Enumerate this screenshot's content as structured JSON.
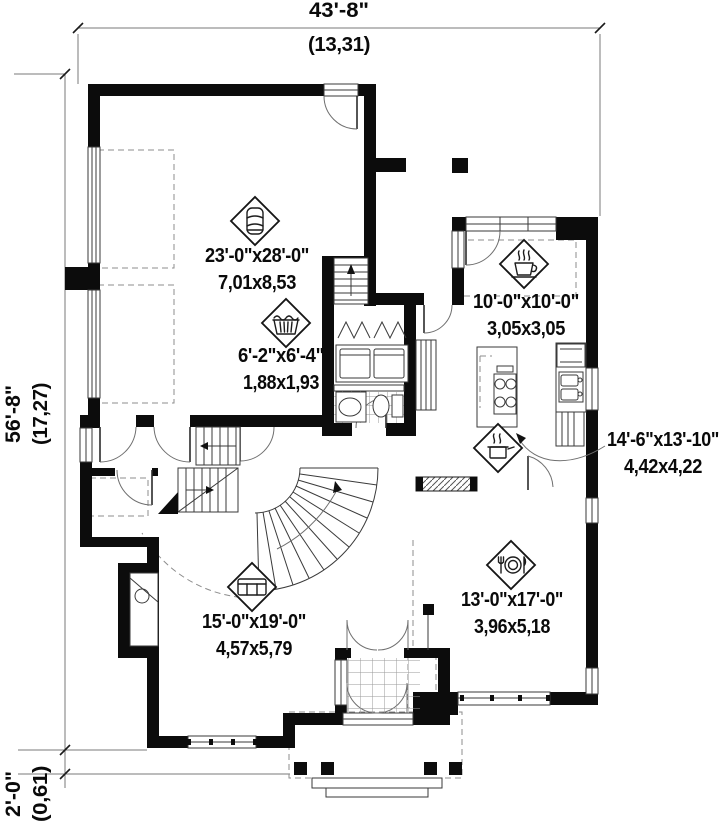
{
  "plan": {
    "title": "first-floor-plan",
    "dimensions": {
      "width": {
        "imperial": "43'-8\"",
        "metric": "(13,31)"
      },
      "height": {
        "imperial": "56'-8\"",
        "metric": "(17,27)"
      },
      "porch_offset": {
        "imperial": "2'-0\"",
        "metric": "(0,61)"
      }
    },
    "rooms": [
      {
        "id": "garage",
        "icon": "car-icon",
        "imperial": "23'-0\"x28'-0\"",
        "metric": "7,01x8,53"
      },
      {
        "id": "dinette",
        "icon": "coffee-cup-icon",
        "imperial": "10'-0\"x10'-0\"",
        "metric": "3,05x3,05"
      },
      {
        "id": "laundry",
        "icon": "laundry-basket-icon",
        "imperial": "6'-2\"x6'-4\"",
        "metric": "1,88x1,93"
      },
      {
        "id": "kitchen",
        "icon": "cooking-pot-icon",
        "imperial": "14'-6\"x13'-10\"",
        "metric": "4,42x4,22"
      },
      {
        "id": "living",
        "icon": "sofa-icon",
        "imperial": "15'-0\"x19'-0\"",
        "metric": "4,57x5,79"
      },
      {
        "id": "dining",
        "icon": "plate-cutlery-icon",
        "imperial": "13'-0\"x17'-0\"",
        "metric": "3,96x5,18"
      }
    ],
    "colors": {
      "wall": "#0c0c0c",
      "line": "#3a3a3a",
      "dashed": "#8c8c8c",
      "background": "#ffffff"
    }
  }
}
